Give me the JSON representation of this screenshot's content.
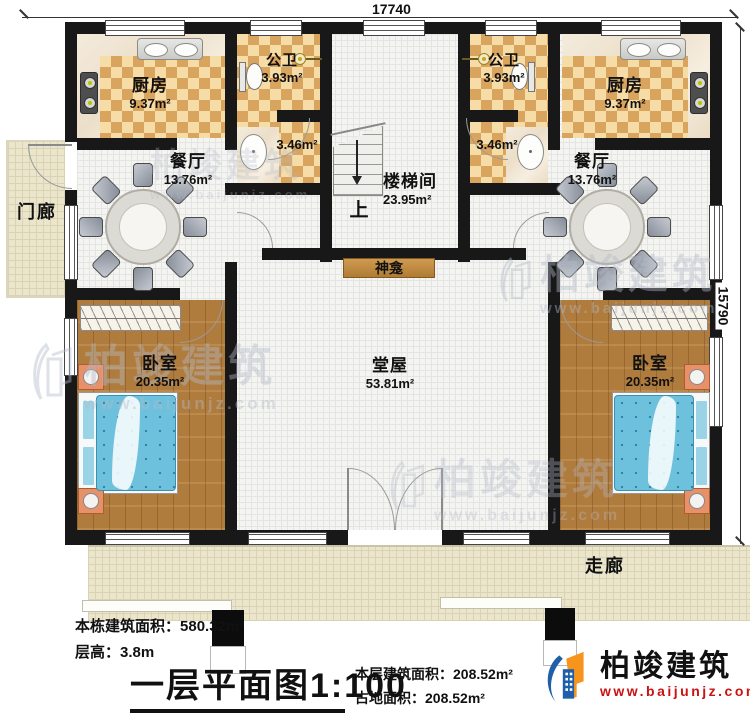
{
  "dimensions": {
    "top": "17740",
    "right": "15790"
  },
  "rooms": {
    "kitchen_left": {
      "name": "厨房",
      "area": "9.37m²"
    },
    "kitchen_right": {
      "name": "厨房",
      "area": "9.37m²"
    },
    "bath_left": {
      "name": "公卫",
      "area": "3.93m²"
    },
    "bath_right": {
      "name": "公卫",
      "area": "3.93m²"
    },
    "wash_left": {
      "area": "3.46m²"
    },
    "wash_right": {
      "area": "3.46m²"
    },
    "dining_left": {
      "name": "餐厅",
      "area": "13.76m²"
    },
    "dining_right": {
      "name": "餐厅",
      "area": "13.76m²"
    },
    "stairwell": {
      "name": "楼梯间",
      "area": "23.95m²",
      "up": "上"
    },
    "porch": {
      "name": "门廊"
    },
    "shrine": {
      "name": "神龛"
    },
    "hall": {
      "name": "堂屋",
      "area": "53.81m²"
    },
    "bedroom_left": {
      "name": "卧室",
      "area": "20.35m²"
    },
    "bedroom_right": {
      "name": "卧室",
      "area": "20.35m²"
    },
    "corridor": {
      "name": "走廊"
    }
  },
  "info": {
    "building_area_label": "本栋建筑面积：",
    "building_area": "580.32m²",
    "floor_height_label": "层高：",
    "floor_height": "3.8m",
    "title": "一层平面图",
    "scale": "1:100",
    "floor_area_label": "本层建筑面积：",
    "floor_area": "208.52m²",
    "land_area_label": "占地面积：",
    "land_area": "208.52m²"
  },
  "brand": {
    "name": "柏竣建筑",
    "url": "www.baijunjz.com"
  },
  "watermark": {
    "name": "柏竣建筑",
    "url": "www.baijunjz.com"
  },
  "colors": {
    "wall": "#181818",
    "checker_dark": "#d9a55e",
    "checker_light": "#f6dca6",
    "wood": "#b07c3e",
    "bed_blue": "#6ec1dc",
    "logo_blue": "#1d5fa8",
    "logo_orange": "#f7941e",
    "url_red": "#cc1111"
  }
}
